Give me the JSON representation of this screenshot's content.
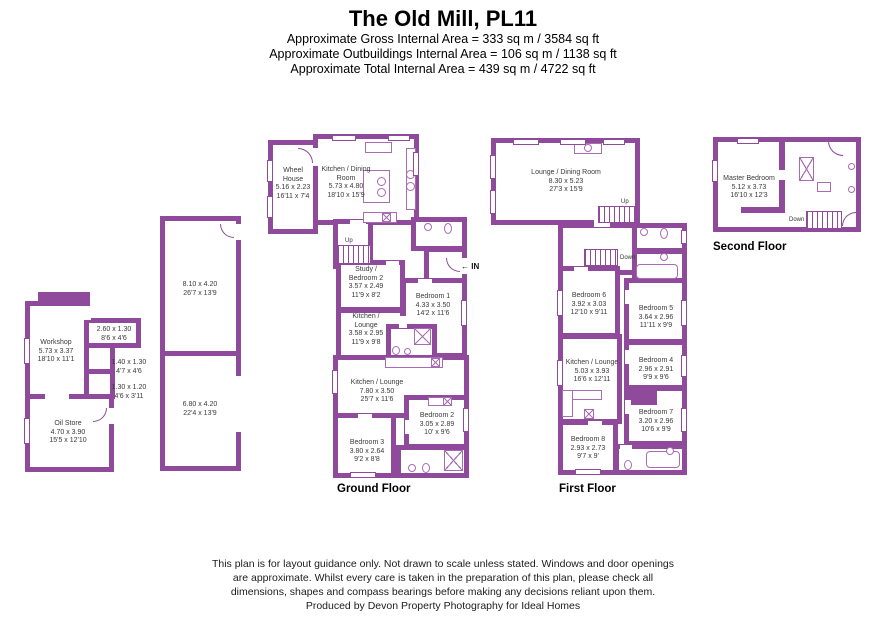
{
  "colors": {
    "wall": "#8f4a9c",
    "fixture": "#a76cb2"
  },
  "header": {
    "title": "The Old Mill, PL11",
    "line1": "Approximate Gross Internal Area = 333 sq m / 3584 sq ft",
    "line2": "Approximate Outbuildings Internal Area = 106 sq m / 1138 sq ft",
    "line3": "Approximate Total Internal Area = 439 sq m / 4722 sq ft"
  },
  "annotations": {
    "up": "Up",
    "down": "Down",
    "in_label": "IN",
    "in_arrow": "←"
  },
  "floors": {
    "outbuildings": {
      "rooms": {
        "workshop": {
          "name": "Workshop",
          "m": "5.73 x 3.37",
          "ft": "18'10 x 11'1"
        },
        "store_a": {
          "m": "2.60 x 1.30",
          "ft": "8'6 x 4'6"
        },
        "store_b": {
          "m": "1.40 x 1.30",
          "ft": "4'7 x 4'6"
        },
        "store_c": {
          "m": "1.30 x 1.20",
          "ft": "4'6 x 3'11"
        },
        "oil_store": {
          "name": "Oil Store",
          "m": "4.70 x 3.90",
          "ft": "15'5 x 12'10"
        },
        "barn_upper": {
          "m": "8.10 x 4.20",
          "ft": "26'7 x 13'9"
        },
        "barn_lower": {
          "m": "6.80 x 4.20",
          "ft": "22'4 x 13'9"
        }
      }
    },
    "ground": {
      "title": "Ground Floor",
      "rooms": {
        "wheel_house": {
          "name": "Wheel House",
          "m": "5.16 x 2.23",
          "ft": "16'11 x 7'4"
        },
        "kitchen_dining": {
          "name": "Kitchen / Dining Room",
          "m": "5.73 x 4.80",
          "ft": "18'10 x 15'9"
        },
        "study_bedroom2": {
          "name": "Study / Bedroom 2",
          "m": "3.57 x 2.49",
          "ft": "11'9 x 8'2"
        },
        "bedroom1": {
          "name": "Bedroom 1",
          "m": "4.33 x 3.50",
          "ft": "14'2 x 11'6"
        },
        "kitchen_lounge_small": {
          "name": "Kitchen / Lounge",
          "m": "3.58 x 2.95",
          "ft": "11'9 x 9'8"
        },
        "kitchen_lounge_large": {
          "name": "Kitchen / Lounge",
          "m": "7.80 x 3.50",
          "ft": "25'7 x 11'6"
        },
        "bedroom2": {
          "name": "Bedroom 2",
          "m": "3.05 x 2.89",
          "ft": "10' x 9'6"
        },
        "bedroom3": {
          "name": "Bedroom 3",
          "m": "3.80 x 2.64",
          "ft": "9'2 x 8'8"
        }
      }
    },
    "first": {
      "title": "First Floor",
      "rooms": {
        "lounge_dining": {
          "name": "Lounge / Dining Room",
          "m": "8.30 x 5.23",
          "ft": "27'3 x 15'9"
        },
        "bedroom6": {
          "name": "Bedroom 6",
          "m": "3.92 x 3.03",
          "ft": "12'10 x 9'11"
        },
        "bedroom5": {
          "name": "Bedroom 5",
          "m": "3.64 x 2.96",
          "ft": "11'11 x 9'9"
        },
        "kitchen_lounge": {
          "name": "Kitchen / Lounge",
          "m": "5.03 x 3.93",
          "ft": "16'6 x 12'11"
        },
        "bedroom4": {
          "name": "Bedroom 4",
          "m": "2.96 x 2.91",
          "ft": "9'9 x 9'6"
        },
        "bedroom7": {
          "name": "Bedroom 7",
          "m": "3.20 x 2.96",
          "ft": "10'6 x 9'9"
        },
        "bedroom8": {
          "name": "Bedroom 8",
          "m": "2.93 x 2.73",
          "ft": "9'7 x 9'"
        }
      }
    },
    "second": {
      "title": "Second Floor",
      "rooms": {
        "master_bedroom": {
          "name": "Master Bedroom",
          "m": "5.12 x 3.73",
          "ft": "16'10 x 12'3"
        }
      }
    }
  },
  "footer": {
    "line1": "This plan is for layout guidance only. Not drawn to scale unless stated. Windows and door openings",
    "line2": "are approximate. Whilst every care is taken in the preparation of this plan, please check all",
    "line3": "dimensions, shapes and compass bearings before making any decisions reliant upon them.",
    "line4": "Produced by Devon Property Photography for Ideal Homes"
  }
}
